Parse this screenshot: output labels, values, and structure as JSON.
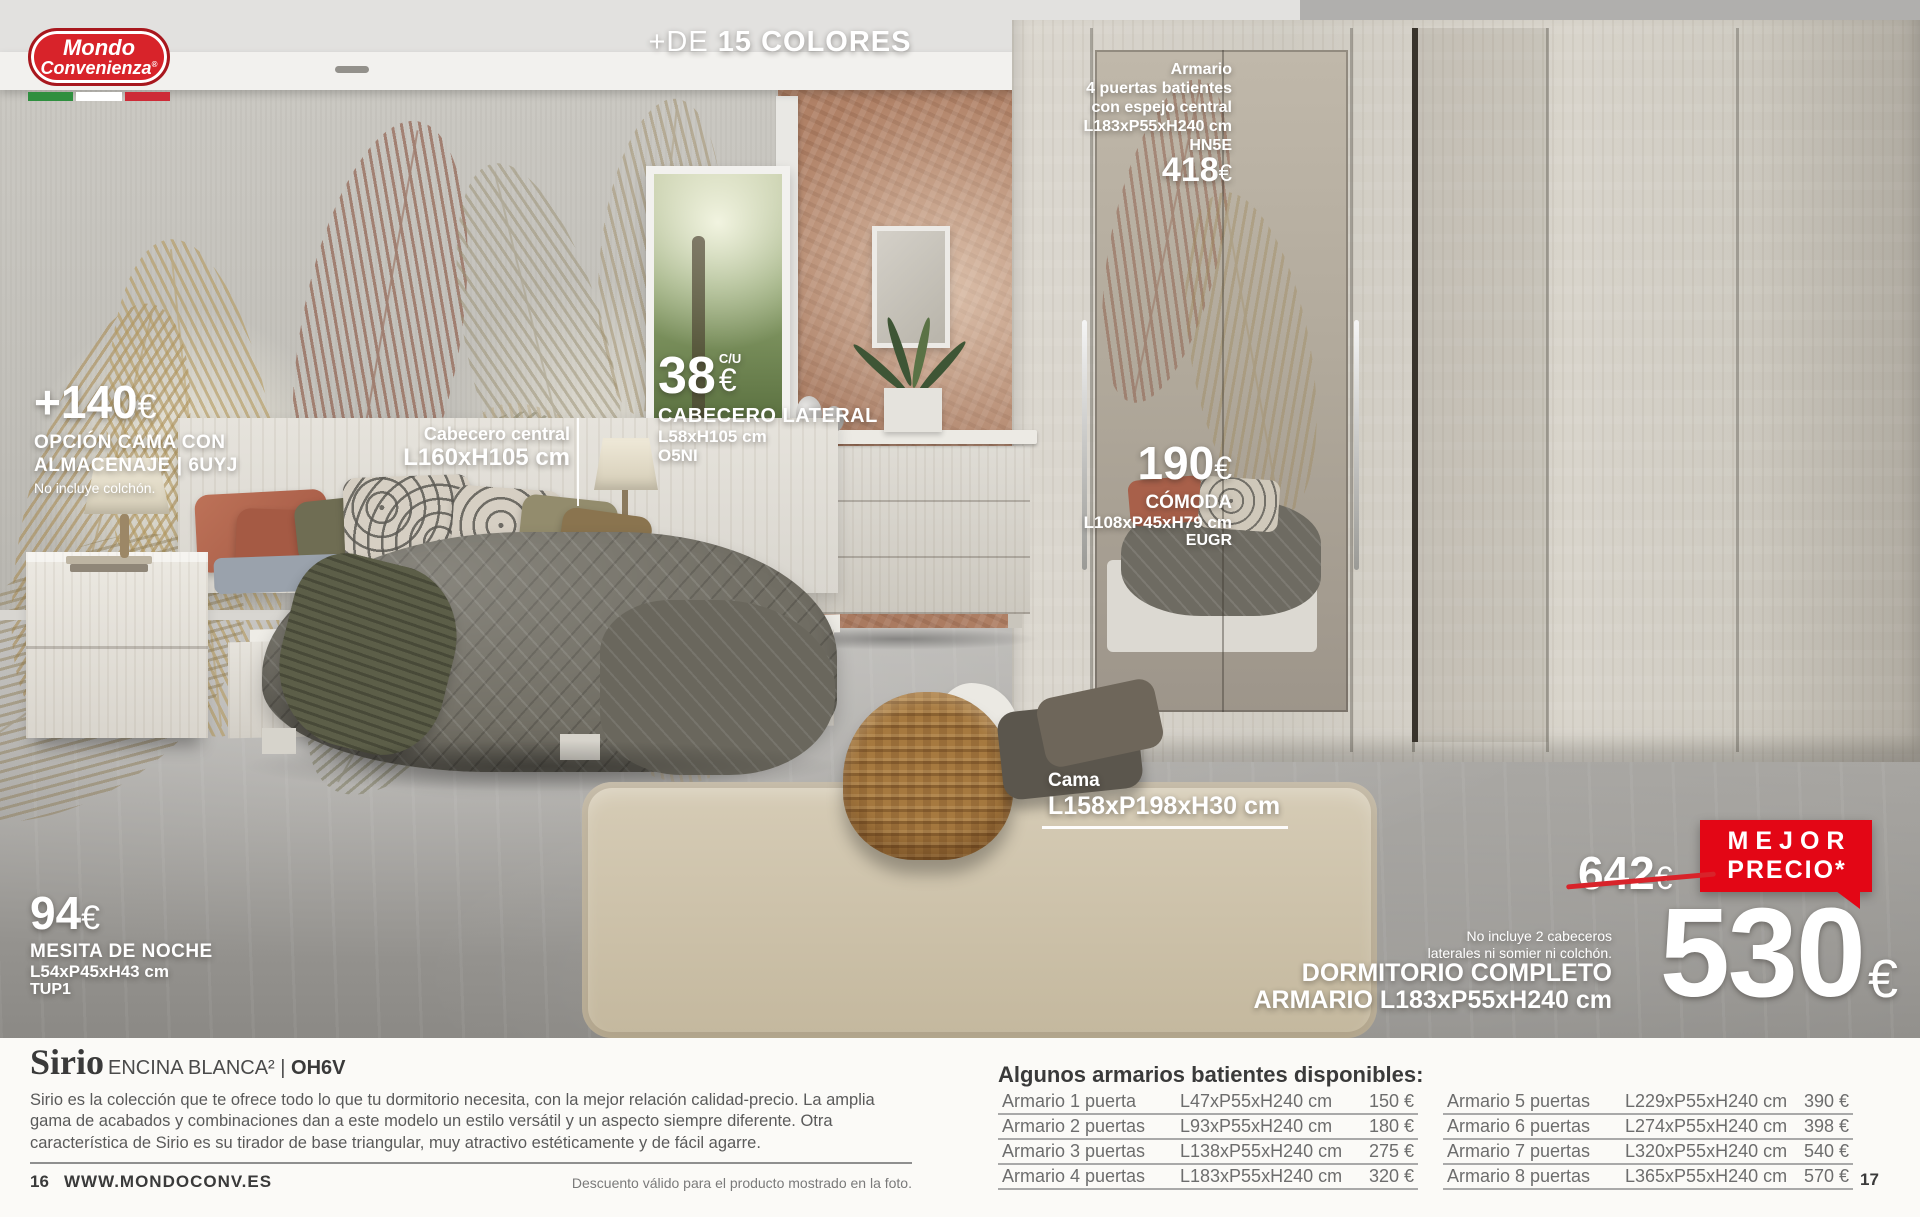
{
  "colors": {
    "brand_red": "#d8232a",
    "badge_red": "#e30615",
    "flag_green": "#2f8f3f",
    "flag_white": "#ffffff",
    "flag_red": "#cd2b37"
  },
  "logo": {
    "line1": "Mondo",
    "line2": "Convenienza",
    "registered": "®"
  },
  "claim": {
    "light": "+DE",
    "bold": "15 COLORES"
  },
  "wardrobe_offer": {
    "line1": "Armario",
    "line2": "4 puertas batientes",
    "line3": "con espejo central",
    "dims": "L183xP55xH240 cm",
    "code": "HN5E",
    "price": "418",
    "euro": "€"
  },
  "storage_option": {
    "price": "+140",
    "euro": "€",
    "line1": "OPCIÓN CAMA CON",
    "line2": "ALMACENAJE | 6UYJ",
    "note": "No incluye colchón."
  },
  "central_headboard": {
    "name": "Cabecero central",
    "dims": "L160xH105 cm"
  },
  "lateral_headboard": {
    "price": "38",
    "per_unit": "C/U",
    "euro": "€",
    "name": "CABECERO LATERAL",
    "dims": "L58xH105 cm",
    "code": "O5NI"
  },
  "comoda": {
    "price": "190",
    "euro": "€",
    "name": "CÓMODA",
    "dims": "L108xP45xH79 cm",
    "code": "EUGR"
  },
  "cama": {
    "name": "Cama",
    "dims": "L158xP198xH30 cm"
  },
  "mesita": {
    "price": "94",
    "euro": "€",
    "name": "MESITA DE NOCHE",
    "dims": "L54xP45xH43 cm",
    "code": "TUP1"
  },
  "deal": {
    "old_price": "642",
    "old_euro": "€",
    "badge_line1": "MEJOR",
    "badge_line2": "PRECIO*",
    "note_line1": "No incluye 2 cabeceros",
    "note_line2": "laterales ni somier ni colchón.",
    "title_line1": "DORMITORIO COMPLETO",
    "title_line2": "ARMARIO L183xP55xH240 cm",
    "price": "530",
    "euro": "€"
  },
  "collection": {
    "name": "Sirio",
    "finish": "ENCINA BLANCA²",
    "separator": "|",
    "code": "OH6V",
    "description": "Sirio es la colección que te ofrece todo lo que tu dormitorio necesita, con la mejor relación calidad-precio. La amplia gama de acabados y combinaciones dan a este modelo un estilo versátil y un aspecto siempre diferente. Otra característica de Sirio es su tirador de base triangular, muy atractivo estéticamente y de fácil agarre."
  },
  "availability": {
    "title": "Algunos armarios batientes disponibles:",
    "left": [
      {
        "name": "Armario 1 puerta",
        "dims": "L47xP55xH240 cm",
        "price": "150 €"
      },
      {
        "name": "Armario 2 puertas",
        "dims": "L93xP55xH240 cm",
        "price": "180 €"
      },
      {
        "name": "Armario 3 puertas",
        "dims": "L138xP55xH240 cm",
        "price": "275 €"
      },
      {
        "name": "Armario 4 puertas",
        "dims": "L183xP55xH240 cm",
        "price": "320 €"
      }
    ],
    "right": [
      {
        "name": "Armario 5 puertas",
        "dims": "L229xP55xH240 cm",
        "price": "390 €"
      },
      {
        "name": "Armario 6 puertas",
        "dims": "L274xP55xH240 cm",
        "price": "398 €"
      },
      {
        "name": "Armario 7 puertas",
        "dims": "L320xP55xH240 cm",
        "price": "540 €"
      },
      {
        "name": "Armario 8 puertas",
        "dims": "L365xP55xH240 cm",
        "price": "570 €"
      }
    ]
  },
  "footer": {
    "page_left": "16",
    "website": "WWW.MONDOCONV.ES",
    "disclaimer": "Descuento válido para el producto mostrado en la foto.",
    "page_right": "17"
  }
}
